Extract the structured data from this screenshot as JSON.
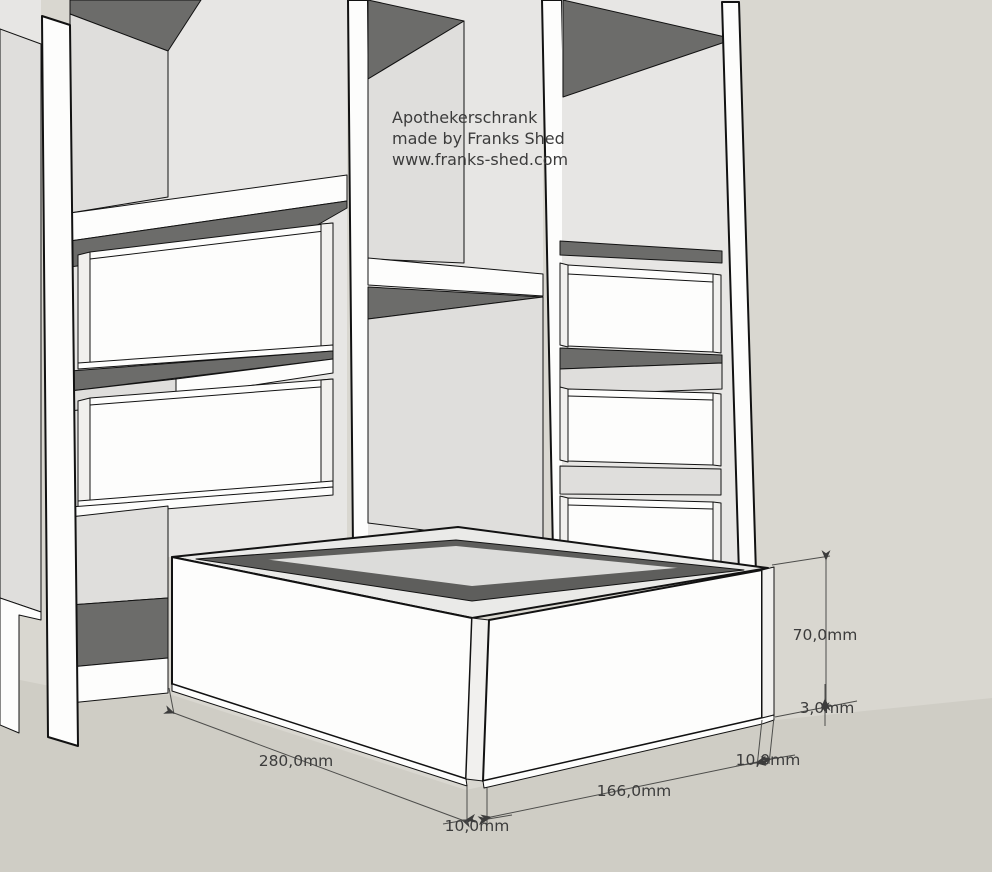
{
  "scene": {
    "title_lines": {
      "line1": "Apothekerschrank",
      "line2": "made by Franks Shed",
      "line3": "www.franks-shed.com"
    }
  },
  "dims": {
    "length_left": "280,0mm",
    "wall_front": "10,0mm",
    "length_right": "166,0mm",
    "wall_right": "10,0mm",
    "height": "70,0mm",
    "bottom_thickness": "3,0mm"
  },
  "colors": {
    "sky": "#d9d7d0",
    "ground": "#cfcdc5",
    "face_white": "#fdfdfc",
    "face_white2": "#f1f0ee",
    "wall": "#e7e6e4",
    "wall_dark": "#dfdedc",
    "shadow": "#6c6c6a",
    "rim": "#eaeae8",
    "box_floor": "#dcdcda",
    "interior_shadow": "#5e5e5c",
    "line": "#121212",
    "ann_line": "#4d4d4b",
    "ann_text": "#3c3c3c"
  }
}
